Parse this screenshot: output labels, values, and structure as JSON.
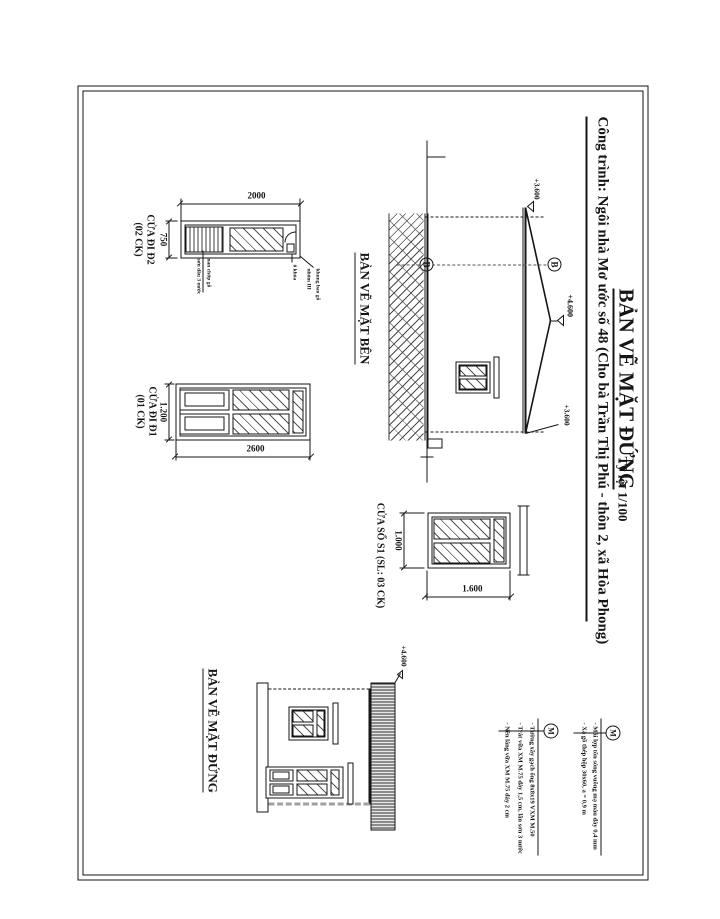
{
  "title_block": {
    "title": "BẢN VẼ MẶT ĐỨNG",
    "scale": "Tỷ lệ: 1/100",
    "project": "Công trình: Ngôi nhà Mơ ước số 48 (Cho bà Trần Thị Phú - thôn 2, xã Hòa Phong)"
  },
  "door_d2": {
    "name": "CỬA ĐI Đ2",
    "count": "(02 CK)",
    "width": "750",
    "height": "2000",
    "note_louver_1": "nan chớp gỗ",
    "note_louver_2": "sơn dầu 3 nước",
    "note_lock": "ổ khóa",
    "note_frame_1": "khung bao gỗ",
    "note_frame_2": "nhóm III"
  },
  "door_d1": {
    "name": "CỬA ĐI Đ1",
    "count": "(01 CK)",
    "width": "1.200",
    "height": "2600"
  },
  "window_s1": {
    "name": "CỬA SỔ S1 (SL: 03 CK)",
    "width": "1.000",
    "height": "1.600"
  },
  "side_elevation": {
    "caption": "BẢN VẼ MẶT BÊN",
    "level_ridge": "+4.600",
    "level_eave_left": "+3.600",
    "level_eave_right": "+3.600",
    "axis_top": "B",
    "axis_bottom": "B"
  },
  "front_elevation": {
    "caption": "BẢN VẼ MẶT ĐỨNG",
    "level_roof": "+4.600"
  },
  "callout_roof": {
    "symbol": "M",
    "lines": [
      "- Mái lợp tôn sóng vuông mạ màu dày 0,4 mm",
      "- Xà gồ thép hộp 30x60, a = 0,9 m"
    ]
  },
  "callout_wall": {
    "symbol": "M",
    "lines": [
      "- Tường xây gạch ống 8x8x19 VXM M.50",
      "- Trát vữa XM M.75 dày 1,5 cm, lăn sơn 3 nước",
      "- Nền láng vữa XM M.75 dày 2 cm"
    ]
  }
}
